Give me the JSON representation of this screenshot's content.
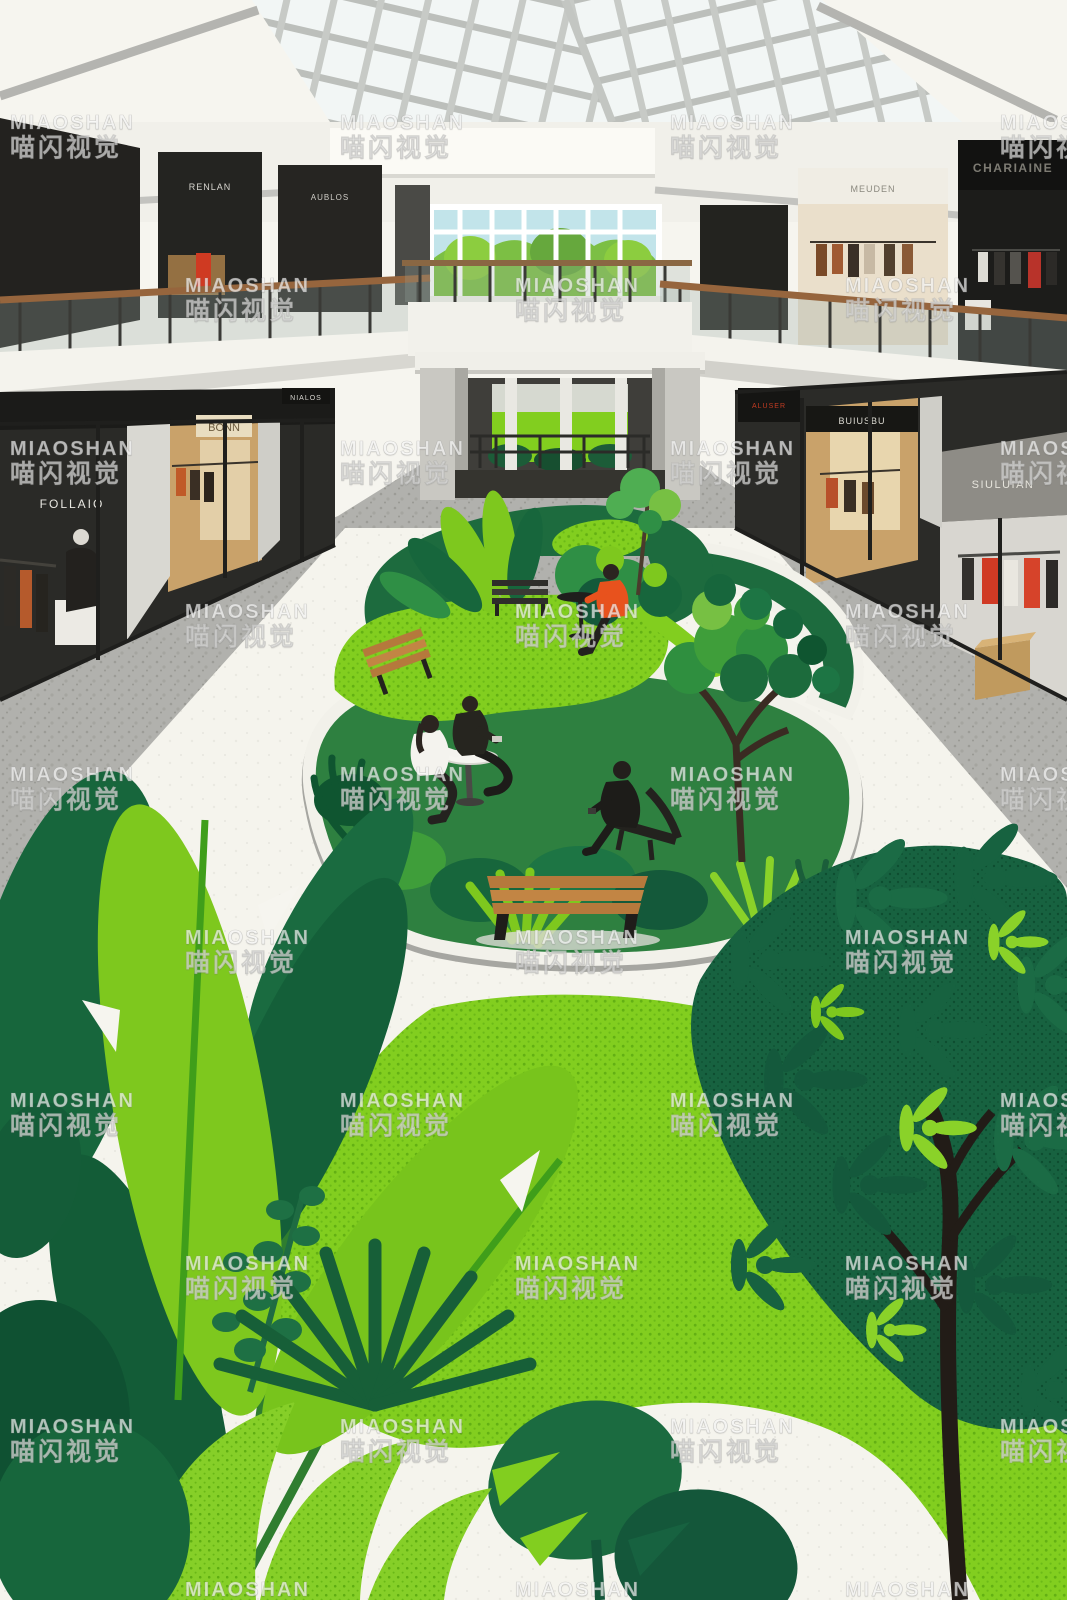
{
  "image": {
    "type": "stock illustration",
    "subject": "two-storey shopping mall atrium with skylight and indoor garden courtyard, four people seated among planters",
    "style": "flat watercolor / risograph halftone"
  },
  "watermark": {
    "line1": "MIAOSHAN",
    "line2": "喵闪视觉",
    "grid": {
      "start_x": 10,
      "odd_row_x": 185,
      "start_y": 112,
      "step_x": 330,
      "step_y": 163,
      "rows": 10
    }
  },
  "signs": {
    "upper_left_1": "RENLAN",
    "upper_left_2": "AUBLOS",
    "upper_right_cream": "MEUDEN",
    "upper_right_dark": "CHARIAINE",
    "lower_left_dark": "FOLLAIO",
    "lower_left_warm": "BONN",
    "lower_left_small": "NIALOS",
    "lower_right_red": "ALUSER",
    "lower_right_warm": "BUIUSBU",
    "lower_right_gray": "SIULUIAN"
  },
  "palette": {
    "paper": "#f6f5ef",
    "floor_white": "#f5f4ed",
    "gray_path": "#b1b1ad",
    "gray_speckle": "#9c9c97",
    "mullion": "#b9bcb8",
    "storefront_black": "#23221f",
    "warm_interior": "#c9a26a",
    "sky_window": "#c2e4ea",
    "lawn": "#82ce1f",
    "green_bright": "#7ec81e",
    "green_mid": "#2f8f45",
    "green_dark": "#17663c",
    "green_deep": "#0e5132",
    "wood": "#b5793c",
    "wood_dark": "#8a5527",
    "orange": "#e8521d",
    "trunk": "#221c17"
  }
}
